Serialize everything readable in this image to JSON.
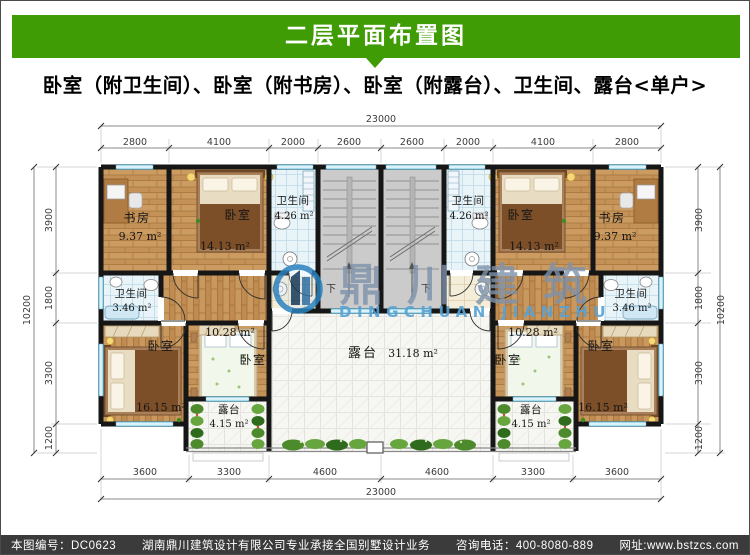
{
  "header": {
    "title": "二层平面布置图",
    "bg_color": "#409c05"
  },
  "subtitle": "卧室（附卫生间）、卧室（附书房）、卧室（附露台）、卫生间、露台<单户>",
  "plan": {
    "dimensions": {
      "top_total": "23000",
      "top_segments": [
        "2800",
        "4100",
        "2000",
        "2600",
        "2600",
        "2000",
        "4100",
        "2800"
      ],
      "bottom_segments": [
        "3600",
        "3300",
        "4600",
        "4600",
        "3300",
        "3600"
      ],
      "bottom_total": "23000",
      "side_segments": [
        "3900",
        "1800",
        "3300",
        "1200"
      ],
      "side_total": "10200"
    },
    "rooms": {
      "study": {
        "name": "书房",
        "area": "9.37 m²"
      },
      "bedroom_top": {
        "name": "卧室",
        "area": "14.13 m²"
      },
      "bath_top": {
        "name": "卫生间",
        "area": "4.26 m²"
      },
      "bath_mid": {
        "name": "卫生间",
        "area": "3.46 m²"
      },
      "bedroom_mid": {
        "name": "卧室",
        "area": "10.28 m²"
      },
      "bedroom_corner": {
        "name": "卧室",
        "area": "16.15 m²"
      },
      "terrace_small": {
        "name": "露台",
        "area": "4.15 m²"
      },
      "terrace_main": {
        "name": "露台",
        "area": "31.18 m²"
      },
      "stair_down": "下"
    },
    "watermark": {
      "cn": "鼎川建筑",
      "en": "DINGCHUAN JIANZHU"
    }
  },
  "footer": {
    "drawing_no": "本图编号：DC0623",
    "company": "湖南鼎川建筑设计有限公司专业承接全国别墅设计业务",
    "phone": "咨询电话：400-8080-889",
    "website": "网址:www.bstzcs.com"
  },
  "colors": {
    "header_green": "#409c05",
    "footer_bg": "#3b3b3b",
    "wall": "#161616",
    "wood_floor": "#c49156",
    "bath_tile": "#e9f4f9",
    "stair_gray": "#cbcbcb",
    "terrace_tile": "#f6f6f2",
    "window_glass": "#a3dced",
    "watermark_cn": "#7e92ab",
    "watermark_en": "#57a3d6",
    "plant_green": "#4c8a2c"
  }
}
